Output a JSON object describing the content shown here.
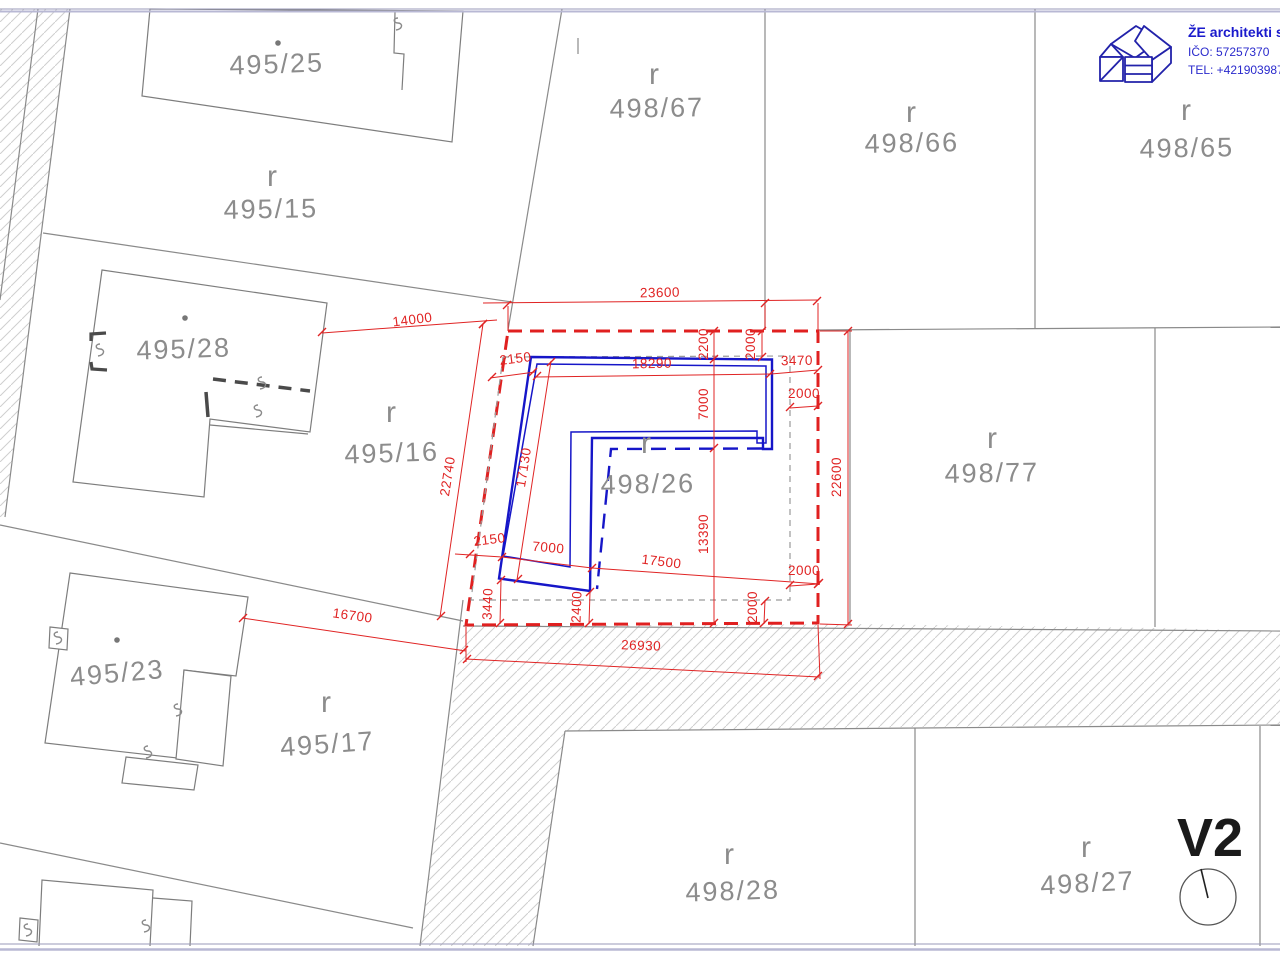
{
  "logo": {
    "company": "ŽE architekti s.r.",
    "ico": "IČO: 57257370",
    "tel": "TEL: +4219039872"
  },
  "variant": "V2",
  "parcels": [
    {
      "id": "495/25",
      "marker": ""
    },
    {
      "id": "495/15",
      "marker": "r"
    },
    {
      "id": "495/28",
      "marker": ""
    },
    {
      "id": "495/16",
      "marker": "r"
    },
    {
      "id": "495/23",
      "marker": ""
    },
    {
      "id": "495/17",
      "marker": "r"
    },
    {
      "id": "498/67",
      "marker": "r"
    },
    {
      "id": "498/66",
      "marker": "r"
    },
    {
      "id": "498/65",
      "marker": "r"
    },
    {
      "id": "498/77",
      "marker": "r"
    },
    {
      "id": "498/26",
      "marker": "r"
    },
    {
      "id": "498/28",
      "marker": "r"
    },
    {
      "id": "498/27",
      "marker": "r"
    }
  ],
  "dimensions_mm": [
    {
      "v": "23600"
    },
    {
      "v": "14000"
    },
    {
      "v": "2150"
    },
    {
      "v": "18290"
    },
    {
      "v": "3470"
    },
    {
      "v": "2200"
    },
    {
      "v": "2000"
    },
    {
      "v": "7000"
    },
    {
      "v": "2000"
    },
    {
      "v": "17130"
    },
    {
      "v": "22740"
    },
    {
      "v": "22600"
    },
    {
      "v": "13390"
    },
    {
      "v": "2150"
    },
    {
      "v": "7000"
    },
    {
      "v": "17500"
    },
    {
      "v": "2000"
    },
    {
      "v": "3440"
    },
    {
      "v": "2400"
    },
    {
      "v": "2000"
    },
    {
      "v": "26930"
    },
    {
      "v": "16700"
    }
  ],
  "colors": {
    "plot_boundary_red": "#e02020",
    "building_blue": "#1616c8",
    "parcel_line_grey": "#8a8a8a",
    "label_grey": "#8c8c8c",
    "logo_blue": "#2222aa"
  }
}
